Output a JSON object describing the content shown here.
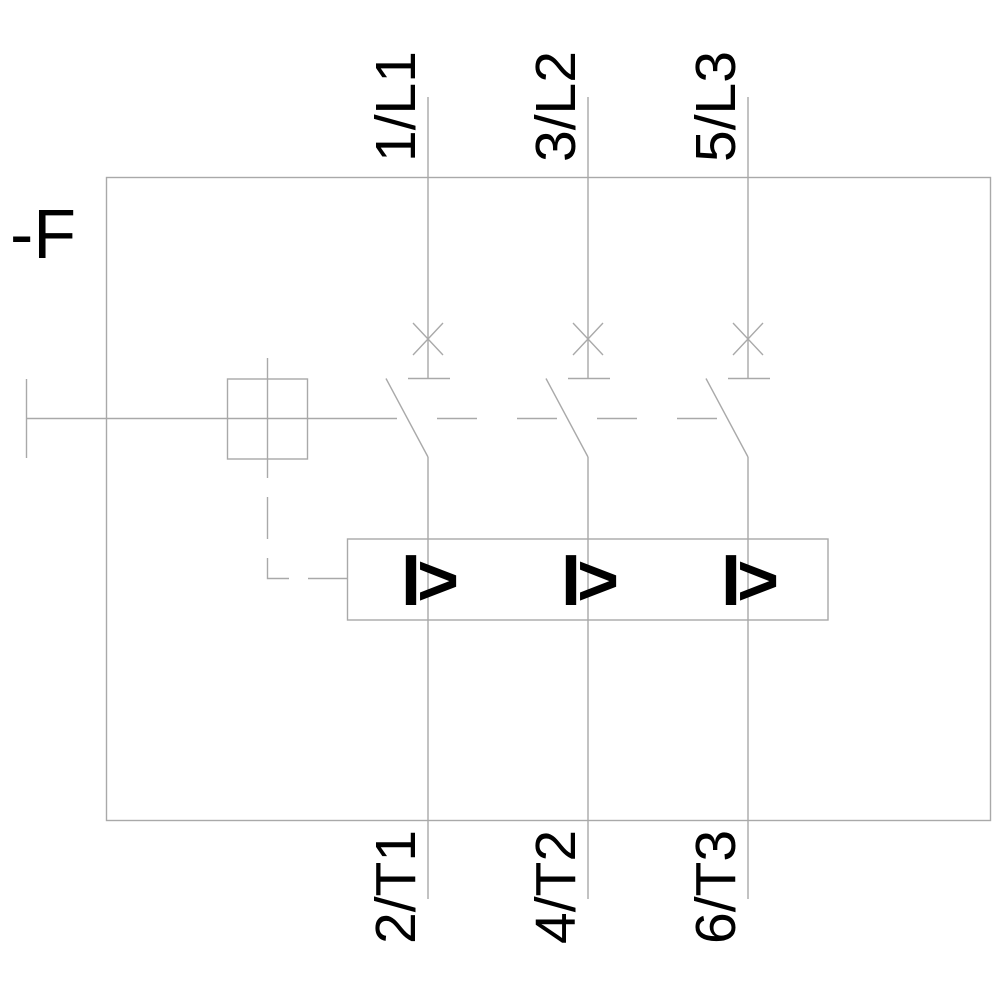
{
  "diagram": {
    "device_designator": "-F",
    "terminals": {
      "top": [
        "1/L1",
        "3/L2",
        "5/L3"
      ],
      "bottom": [
        "2/T1",
        "4/T2",
        "6/T3"
      ]
    },
    "trip_unit": {
      "symbols": [
        "I>",
        "I>",
        "I>"
      ]
    },
    "colors": {
      "line": "#a9a9a9",
      "text": "#000000",
      "background": "#ffffff"
    }
  }
}
